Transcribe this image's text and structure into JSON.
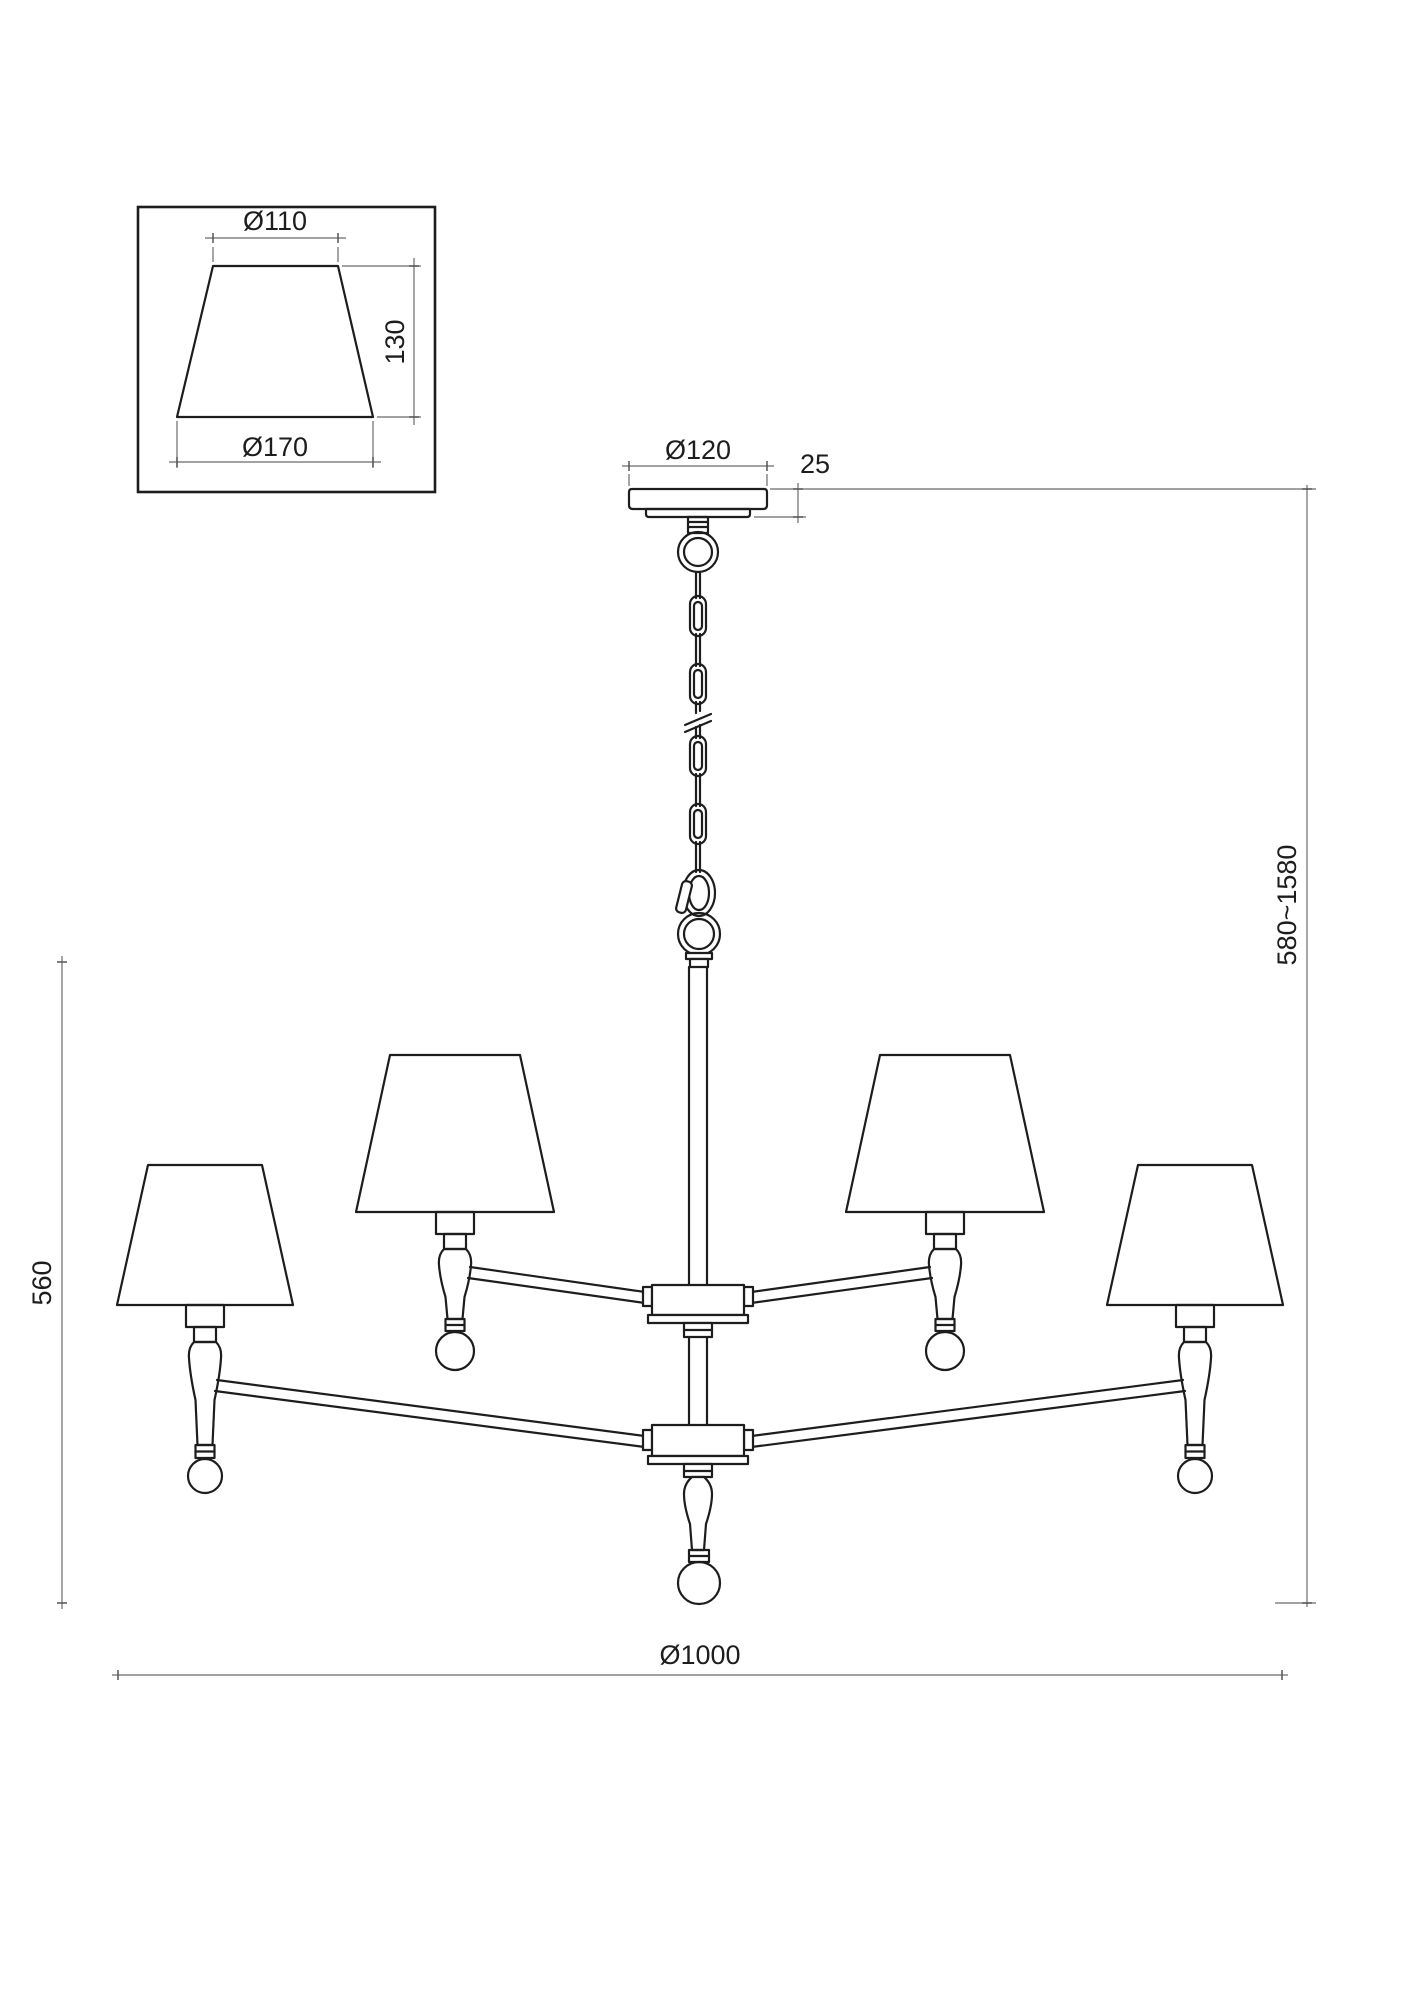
{
  "colors": {
    "background": "#ffffff",
    "line": "#1d1d1d",
    "dimension_line": "#6a6a6a"
  },
  "shade_detail": {
    "top_diameter": "Ø110",
    "height": "130",
    "bottom_diameter": "Ø170"
  },
  "canopy": {
    "diameter": "Ø120",
    "height": "25"
  },
  "overall": {
    "height_range": "580~1580",
    "body_height": "560",
    "diameter": "Ø1000"
  }
}
